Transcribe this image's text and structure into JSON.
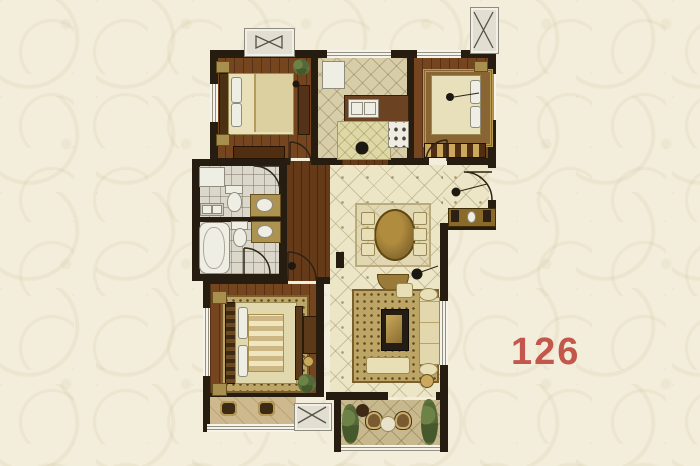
{
  "unit": {
    "area_label": "126",
    "label_color": "#c4574b"
  },
  "icons": {
    "shaft_bowtie_symbol": "bowtie-triangles",
    "shaft_x_symbol": "x-cross",
    "door_symbol": "quarter-arc"
  },
  "palette": {
    "background": "#f3eedb",
    "background_pattern": "#e6dfc4",
    "wall": "#271c10",
    "wood_floor": "#74451f",
    "tile_floor": "#ece5c6",
    "kitchen_tile": "#d7cda9",
    "bath_tile": "#dbd7ca",
    "balcony_tile": "#c7b88d",
    "rug": "#bda566",
    "furniture_light": "#e8dfb6",
    "furniture_gold": "#a98f4d",
    "fixture_white": "#efeee4",
    "plant_green": "#5c713b"
  }
}
